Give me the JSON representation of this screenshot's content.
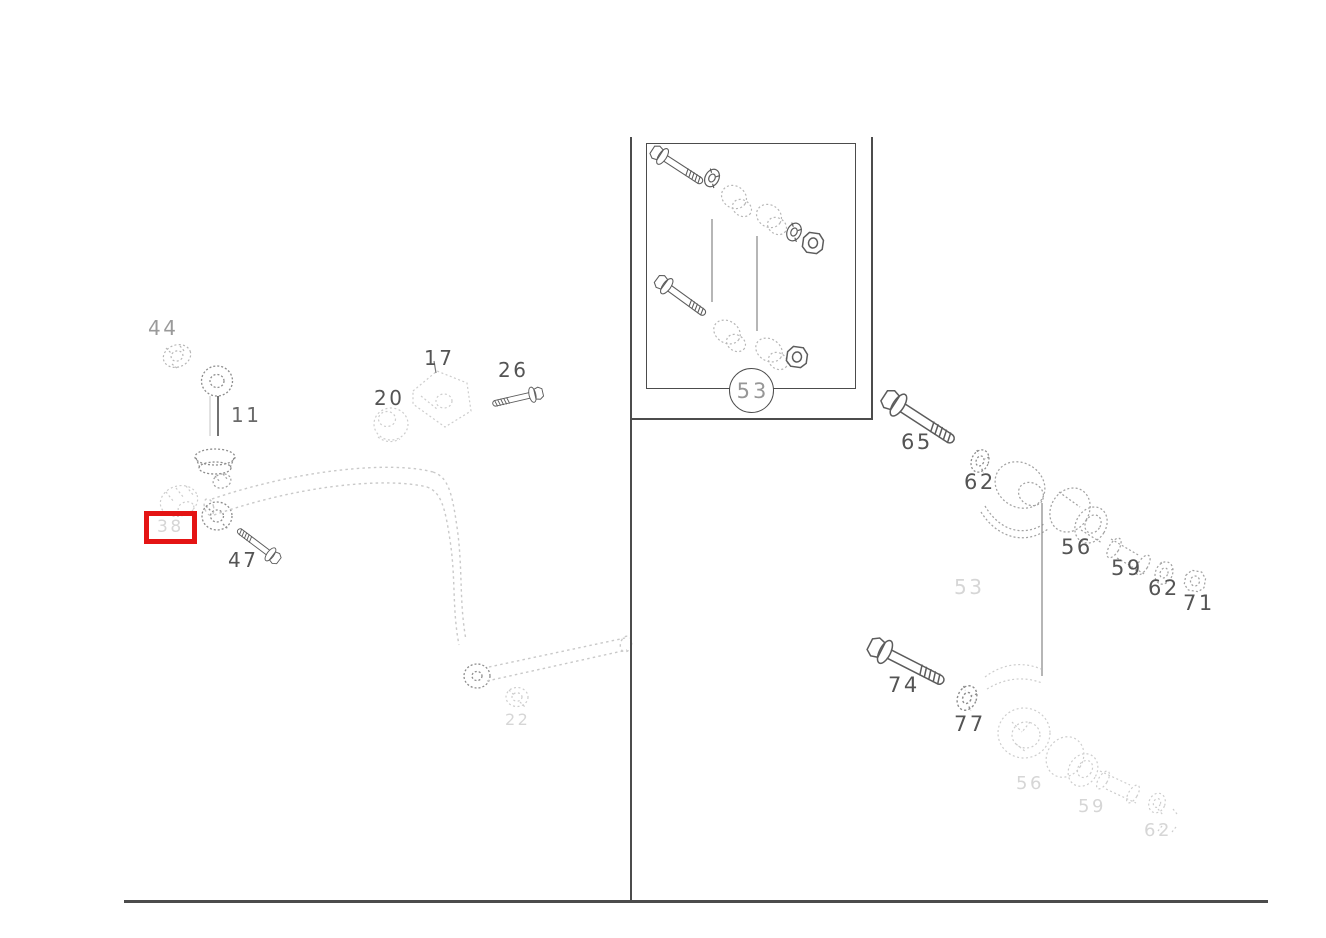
{
  "palette": {
    "highlight_red": "#e41414",
    "line_dark": "#4c4c4c",
    "line_faint": "#c9c9c9",
    "background": "#ffffff"
  },
  "callouts": {
    "c44": {
      "label": "44"
    },
    "c11": {
      "label": "11"
    },
    "c20": {
      "label": "20"
    },
    "c17": {
      "label": "17"
    },
    "c26": {
      "label": "26"
    },
    "c38": {
      "label": "38"
    },
    "c47": {
      "label": "47"
    },
    "c22": {
      "label": "22"
    },
    "c53_inset": {
      "label": "53"
    },
    "c53_link": {
      "label": "53"
    },
    "c65": {
      "label": "65"
    },
    "c62_upper": {
      "label": "62"
    },
    "c56_upper": {
      "label": "56"
    },
    "c59_upper": {
      "label": "59"
    },
    "c62_mid": {
      "label": "62"
    },
    "c71": {
      "label": "71"
    },
    "c74": {
      "label": "74"
    },
    "c77": {
      "label": "77"
    },
    "c56_lower": {
      "label": "56"
    },
    "c59_lower": {
      "label": "59"
    },
    "c62_lower": {
      "label": "62"
    }
  }
}
